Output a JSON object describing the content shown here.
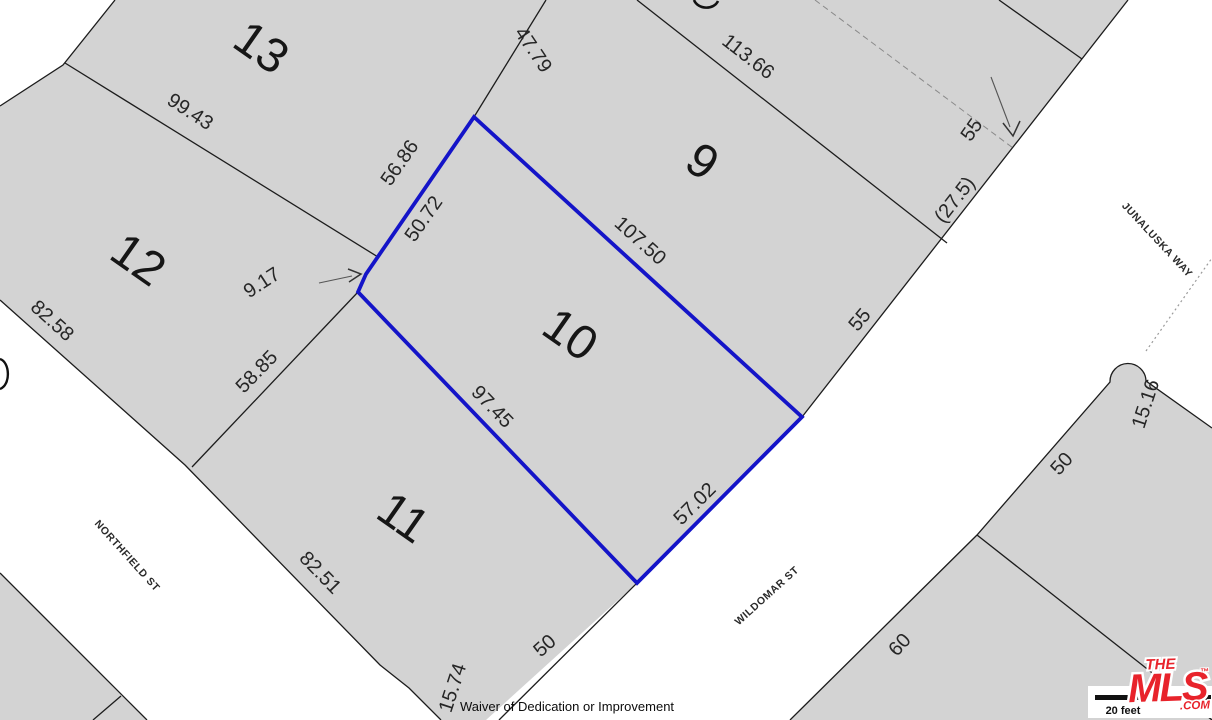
{
  "map": {
    "parcel_fill": "#d3d3d3",
    "line_color": "#1c1c1c",
    "highlight_color": "#1414c8",
    "lot_numbers": [
      {
        "label": "13"
      },
      {
        "label": "12"
      },
      {
        "label": "9"
      },
      {
        "label": "10"
      },
      {
        "label": "11"
      }
    ],
    "dimensions": [
      {
        "label": "99.43"
      },
      {
        "label": "47.79"
      },
      {
        "label": "56.86"
      },
      {
        "label": "50.72"
      },
      {
        "label": "107.50"
      },
      {
        "label": "113.66"
      },
      {
        "label": "9.17"
      },
      {
        "label": "58.85"
      },
      {
        "label": "82.58"
      },
      {
        "label": "82.51"
      },
      {
        "label": "97.45"
      },
      {
        "label": "57.02"
      },
      {
        "label": "15.74"
      },
      {
        "label": "50"
      },
      {
        "label": "55"
      },
      {
        "label": "(27.5)"
      },
      {
        "label": "55"
      },
      {
        "label": "50"
      },
      {
        "label": "60"
      },
      {
        "label": "15.16"
      }
    ],
    "streets": [
      {
        "label": "NORTHFIELD ST"
      },
      {
        "label": "WILDOMAR ST"
      },
      {
        "label": "JUNALUSKA WAY"
      }
    ]
  },
  "scale_bar": {
    "label": "20 feet"
  },
  "logo": {
    "the": "THE",
    "mls": "MLS",
    "tm": "™",
    "com": ".COM"
  },
  "footer": {
    "caption": "Waiver of Dedication or Improvement"
  }
}
